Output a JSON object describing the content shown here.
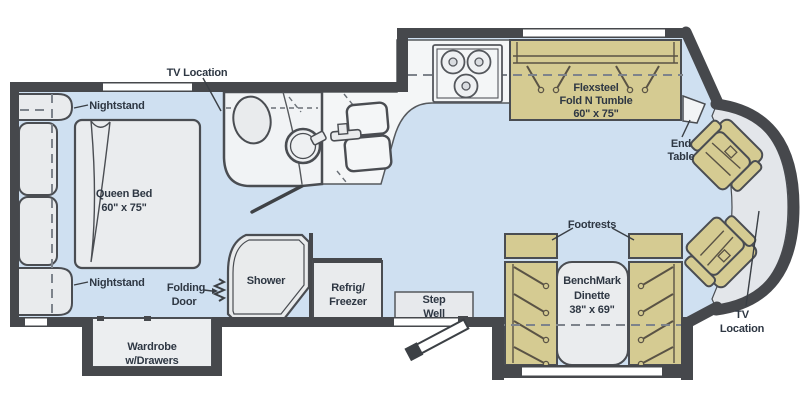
{
  "plan_type": "rv-floorplan",
  "colors": {
    "wall": "#46484c",
    "floor": "#cfe0f1",
    "counter": "#f4f6f7",
    "bathroom_floor": "#f1f3f5",
    "fixture": "#e9ebed",
    "furniture_tan": "#d5cb92",
    "windshield": "#e3e6ea",
    "window": "#ffffff",
    "text": "#2e3743"
  },
  "labels": {
    "tv_bedroom": {
      "l1": "TV Location"
    },
    "nightstand_top": {
      "l1": "Nightstand"
    },
    "queen_bed": {
      "l1": "Queen Bed",
      "l2": "60\" x 75\""
    },
    "nightstand_bottom": {
      "l1": "Nightstand"
    },
    "folding_door": {
      "l1": "Folding",
      "l2": "Door"
    },
    "shower": {
      "l1": "Shower"
    },
    "refrigerator": {
      "l1": "Refrig/",
      "l2": "Freezer"
    },
    "step_well": {
      "l1": "Step",
      "l2": "Well"
    },
    "wardrobe": {
      "l1": "Wardrobe",
      "l2": "w/Drawers"
    },
    "sofa": {
      "l1": "Flexsteel",
      "l2": "Fold N Tumble",
      "l3": "60\" x 75\""
    },
    "end_table": {
      "l1": "End",
      "l2": "Table"
    },
    "footrests": {
      "l1": "Footrests"
    },
    "dinette": {
      "l1": "BenchMark",
      "l2": "Dinette",
      "l3": "38\" x 69\""
    },
    "tv_front": {
      "l1": "TV",
      "l2": "Location"
    }
  }
}
